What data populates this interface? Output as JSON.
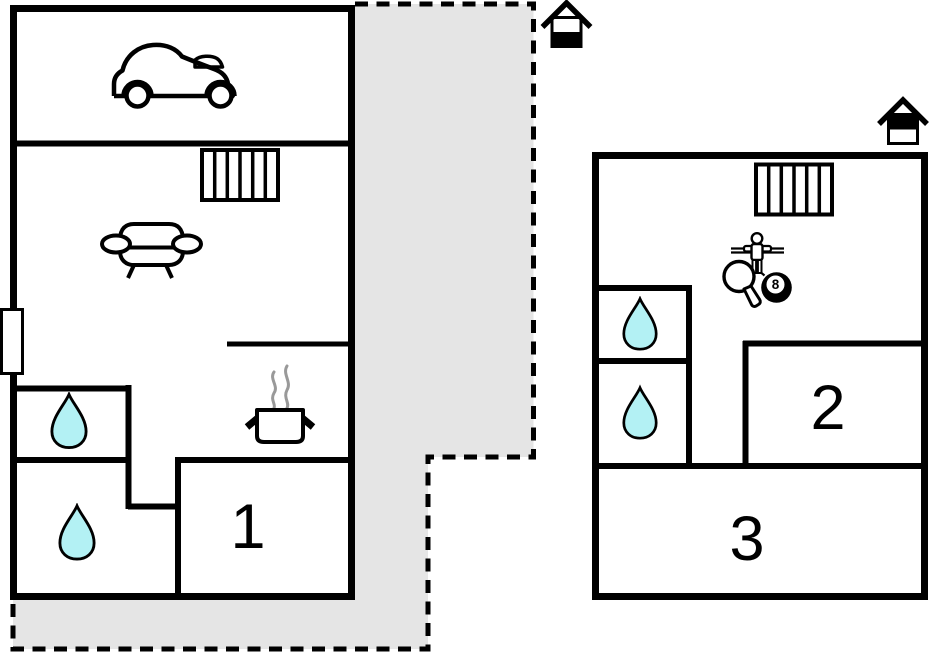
{
  "plan": {
    "type": "floor-plan",
    "background": "#ffffff"
  },
  "colors": {
    "wall": "#000000",
    "terrace_fill": "#e5e5e5",
    "terrace_border": "#000000",
    "water_drop": "#b3f1f4",
    "steam": "#999999",
    "label_text": "#000000"
  },
  "rooms": [
    {
      "id": "room-1",
      "label": "1"
    },
    {
      "id": "room-2",
      "label": "2"
    },
    {
      "id": "room-3",
      "label": "3"
    }
  ],
  "game_room": {
    "eight_ball_label": "8"
  },
  "icons": {
    "entrance_markers": [
      "house-entrance-icon",
      "house-entrance-icon"
    ],
    "garage": "car-icon",
    "living_area": "sofa-icon",
    "heating": [
      "radiator-icon",
      "radiator-icon"
    ],
    "kitchen": [
      "cooking-pot-icon",
      "steam-icon"
    ],
    "bathrooms": [
      "water-drop-icon",
      "water-drop-icon",
      "water-drop-icon",
      "water-drop-icon"
    ],
    "games": [
      "foosball-player-icon",
      "table-tennis-paddle-icon",
      "eight-ball-icon"
    ],
    "window": "window-marker"
  }
}
